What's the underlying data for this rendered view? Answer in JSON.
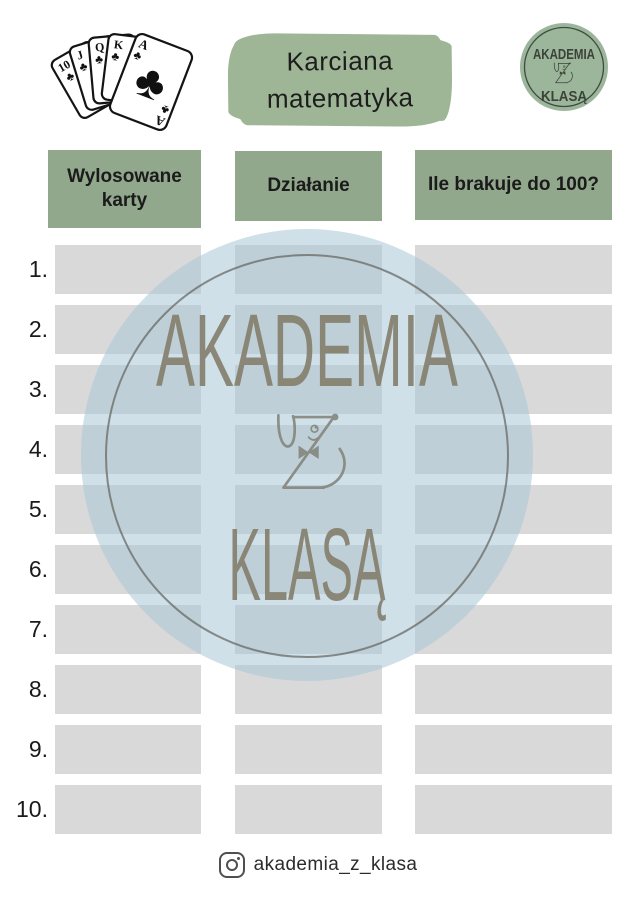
{
  "page": {
    "background": "#ffffff"
  },
  "header": {
    "cards": {
      "ranks": [
        "10",
        "J",
        "Q",
        "K",
        "A"
      ],
      "suit_name": "clubs",
      "suit_char": "♣"
    },
    "title": {
      "line1": "Karciana",
      "line2": "matematyka",
      "bg_color": "#9eb596",
      "text_color": "#1d1d1d"
    },
    "logo": {
      "line1": "AKADEMIA",
      "line2": "KLASĄ",
      "circle_color": "#9cb69b",
      "ring_color": "#3f4c3e",
      "text_color": "#3b4237"
    }
  },
  "table": {
    "header_bg": "#92a88c",
    "cell_bg": "#d9d9d9",
    "columns": [
      "Wylosowane karty",
      "Działanie",
      "Ile brakuje do 100?"
    ],
    "row_numbers": [
      "1.",
      "2.",
      "3.",
      "4.",
      "5.",
      "6.",
      "7.",
      "8.",
      "9.",
      "10."
    ]
  },
  "watermark": {
    "line1": "AKADEMIA",
    "line2": "KLASĄ",
    "disc_color": "rgba(168,199,213,0.55)",
    "ring_color": "#63635c",
    "text_color": "#837d6c"
  },
  "footer": {
    "icon": "instagram-icon",
    "handle": "akademia_z_klasa"
  }
}
